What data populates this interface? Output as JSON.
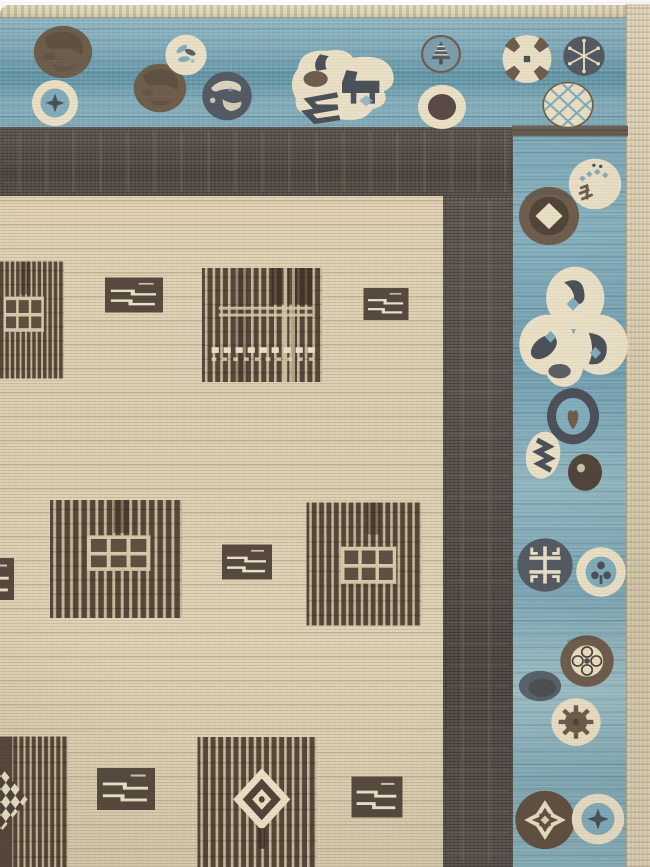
{
  "image_description": "Photograph of the top-right corner of a hand-knotted rug: slate-blue pictorial border filled with circular coin medallions, a charcoal-brown inner frame, and a cream striated field with dark striped square panels and small dashed rectangles.",
  "palette": {
    "page-bg": "#ffffff",
    "selvedge-cream": "#e0d6bb",
    "field-cream": "#dbcfb1",
    "blue-base": "#7ea8b5",
    "blue-deep": "#5f93a4",
    "band-dark": "#57504a",
    "motif-cream": "#eae0c6",
    "motif-slate": "#4d525a",
    "motif-slate2": "#555b63",
    "motif-brown": "#6f5e4d",
    "motif-darkbrown": "#52453a",
    "motif-umber": "#5c4b45",
    "motif-blue": "#83adbb",
    "motif-bluegray": "#7e9dab",
    "square-dark": "#55483a",
    "stripe-cream": "#d6c9a8",
    "guard-brown": "#6a5f52"
  },
  "rug": {
    "areas": {
      "selvedge_top": [
        0,
        5,
        626,
        13
      ],
      "blue_top": [
        0,
        18,
        626,
        109
      ],
      "blue_right": [
        513,
        127,
        113,
        740
      ],
      "selvedge_right": [
        626,
        4,
        24,
        863
      ],
      "dark_h": [
        0,
        127,
        513,
        69
      ],
      "dark_v": [
        443,
        196,
        70,
        671
      ],
      "field": [
        0,
        196,
        443,
        671
      ]
    },
    "motifs": [
      {
        "name": "guard-stripe",
        "sym": "stripe",
        "cx": 570,
        "cy": 131,
        "w": 116,
        "h": 11
      },
      {
        "name": "medallion-brown-disc",
        "sym": "circle-plain",
        "cx": 63,
        "cy": 52,
        "w": 62,
        "h": 58
      },
      {
        "name": "medallion-star-ring",
        "sym": "star-ring",
        "cx": 55,
        "cy": 103,
        "w": 50,
        "h": 50
      },
      {
        "name": "medallion-brown-disc",
        "sym": "circle-plain",
        "cx": 160,
        "cy": 88,
        "w": 56,
        "h": 54
      },
      {
        "name": "medallion-leaf-coin",
        "sym": "leaf-coin",
        "cx": 186,
        "cy": 55,
        "w": 47,
        "h": 46
      },
      {
        "name": "medallion-globe",
        "sym": "globe",
        "cx": 227,
        "cy": 96,
        "w": 55,
        "h": 54
      },
      {
        "name": "medallion-horse-cluster",
        "sym": "horse",
        "cx": 342,
        "cy": 86,
        "w": 110,
        "h": 88
      },
      {
        "name": "medallion-pinecone",
        "sym": "pinecone",
        "cx": 441,
        "cy": 54,
        "w": 44,
        "h": 42
      },
      {
        "name": "medallion-ringed-disc",
        "sym": "ringed-dark",
        "cx": 442,
        "cy": 107,
        "w": 52,
        "h": 48
      },
      {
        "name": "medallion-cross",
        "sym": "cross-medallion",
        "cx": 527,
        "cy": 59,
        "w": 53,
        "h": 52
      },
      {
        "name": "medallion-snowflake",
        "sym": "snowflake",
        "cx": 584,
        "cy": 56,
        "w": 47,
        "h": 45
      },
      {
        "name": "medallion-crosshatch",
        "sym": "crosshatch",
        "cx": 568,
        "cy": 105,
        "w": 55,
        "h": 50
      },
      {
        "name": "medallion-coin-dots",
        "sym": "coin-dots",
        "cx": 595,
        "cy": 184,
        "w": 57,
        "h": 55
      },
      {
        "name": "medallion-diamond-coin",
        "sym": "diamond-coin",
        "cx": 549,
        "cy": 216,
        "w": 64,
        "h": 62
      },
      {
        "name": "medallion-trilobe",
        "sym": "trilobe",
        "cx": 573,
        "cy": 328,
        "w": 112,
        "h": 120
      },
      {
        "name": "medallion-heart-cluster",
        "sym": "heart-cluster",
        "cx": 565,
        "cy": 440,
        "w": 100,
        "h": 108
      },
      {
        "name": "medallion-shou-coin",
        "sym": "shou-coin",
        "cx": 545,
        "cy": 565,
        "w": 60,
        "h": 58
      },
      {
        "name": "medallion-ring-trefoil",
        "sym": "ring-trefoil",
        "cx": 601,
        "cy": 572,
        "w": 55,
        "h": 55
      },
      {
        "name": "medallion-quatrefoil-ring",
        "sym": "quatrefoil-ring",
        "cx": 587,
        "cy": 661,
        "w": 58,
        "h": 56
      },
      {
        "name": "medallion-gray-blob",
        "sym": "gray-blob",
        "cx": 540,
        "cy": 686,
        "w": 46,
        "h": 38
      },
      {
        "name": "medallion-gear-coin",
        "sym": "gear-coin",
        "cx": 576,
        "cy": 722,
        "w": 56,
        "h": 54
      },
      {
        "name": "medallion-arrows",
        "sym": "arrows-circle",
        "cx": 545,
        "cy": 820,
        "w": 63,
        "h": 62
      },
      {
        "name": "medallion-star-ring",
        "sym": "star-ring",
        "cx": 598,
        "cy": 819,
        "w": 57,
        "h": 55
      },
      {
        "name": "field-square-window-partial",
        "sym": "sq-window",
        "cx": 22,
        "cy": 320,
        "w": 84,
        "h": 117
      },
      {
        "name": "field-rect-dash",
        "sym": "rect-dash",
        "cx": 134,
        "cy": 295,
        "w": 58,
        "h": 35
      },
      {
        "name": "field-square-plaid",
        "sym": "sq-plaid",
        "cx": 262,
        "cy": 325,
        "w": 120,
        "h": 114
      },
      {
        "name": "field-rect-dash",
        "sym": "rect-dash",
        "cx": 386,
        "cy": 304,
        "w": 45,
        "h": 32
      },
      {
        "name": "field-rect-dash",
        "sym": "rect-dash",
        "cx": -8,
        "cy": 579,
        "w": 44,
        "h": 42
      },
      {
        "name": "field-square-window",
        "sym": "sq-window",
        "cx": 116,
        "cy": 559,
        "w": 132,
        "h": 118
      },
      {
        "name": "field-rect-dash",
        "sym": "rect-dash",
        "cx": 247,
        "cy": 562,
        "w": 50,
        "h": 35
      },
      {
        "name": "field-square-window",
        "sym": "sq-window2",
        "cx": 364,
        "cy": 564,
        "w": 115,
        "h": 123
      },
      {
        "name": "field-square-checker-partial",
        "sym": "sq-checker",
        "cx": 20,
        "cy": 802,
        "w": 96,
        "h": 131
      },
      {
        "name": "field-rect-dash",
        "sym": "rect-dash",
        "cx": 126,
        "cy": 789,
        "w": 58,
        "h": 42
      },
      {
        "name": "field-square-diamond",
        "sym": "sq-diamond",
        "cx": 257,
        "cy": 802,
        "w": 119,
        "h": 130
      },
      {
        "name": "field-rect-dash",
        "sym": "rect-dash",
        "cx": 377,
        "cy": 797,
        "w": 51,
        "h": 41
      }
    ]
  }
}
